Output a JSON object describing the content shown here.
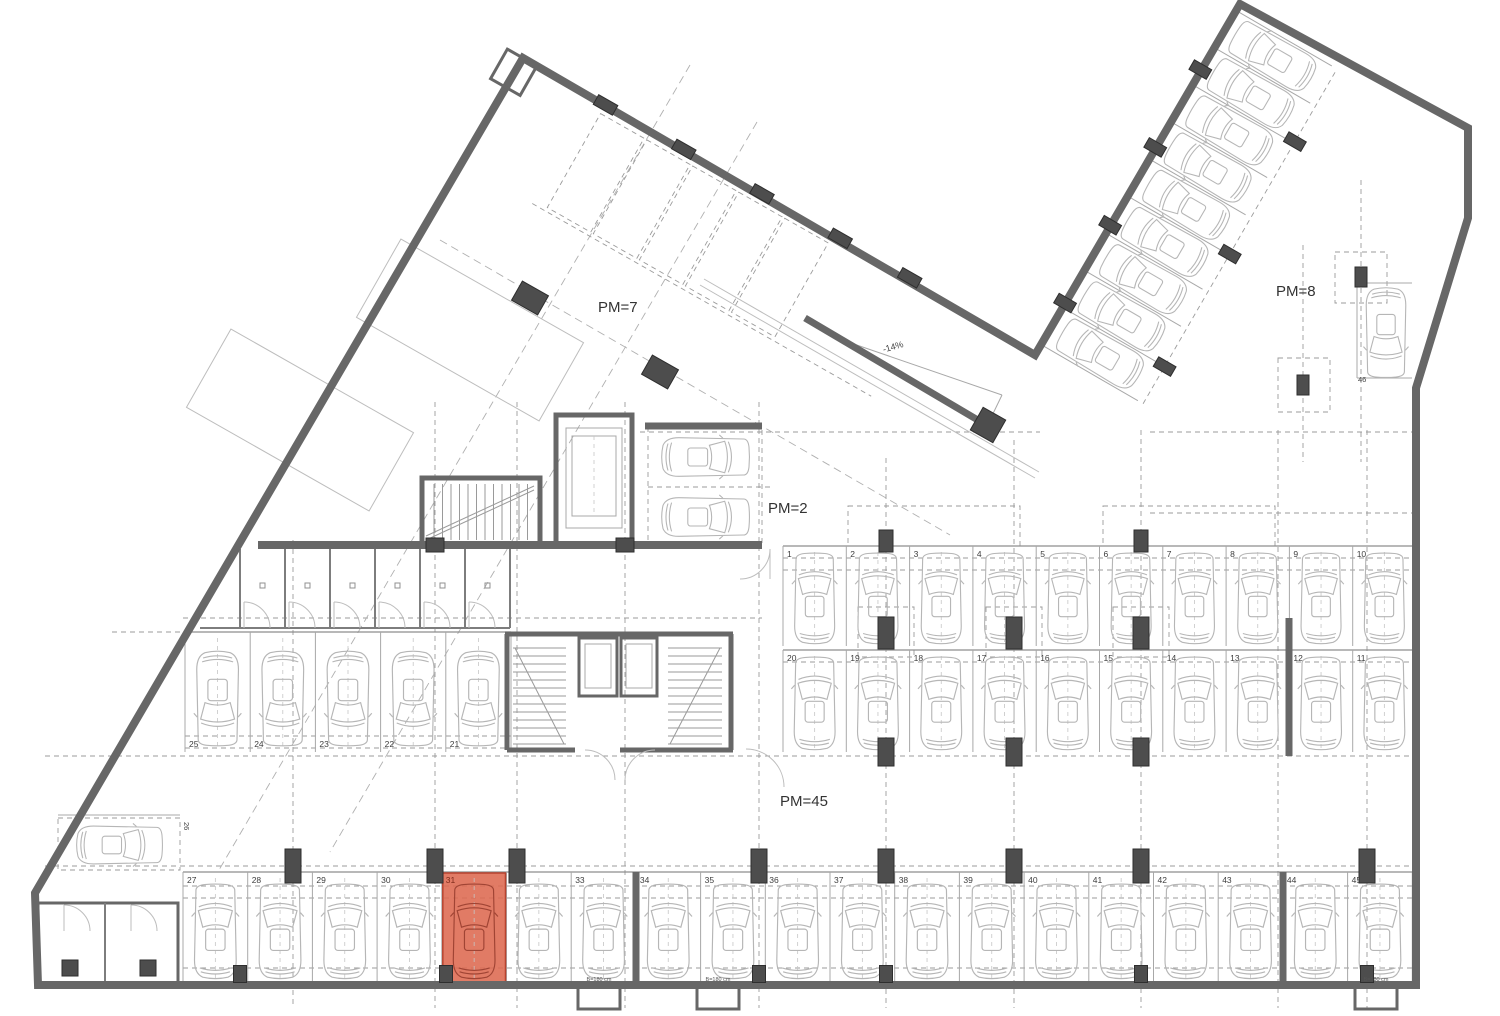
{
  "plan": {
    "labels": {
      "zone_pm7": "PM=7",
      "zone_pm8": "PM=8",
      "zone_pm2": "PM=2",
      "zone_pm45": "PM=45",
      "ramp_slope": "-14%",
      "stall_46": "46",
      "stall_26": "26",
      "niche_width": "B=180 cm"
    },
    "colors": {
      "wall": "#676767",
      "column": "#4d4d4d",
      "car": "#b6b6b6",
      "highlight_fill": "#dd6950",
      "highlight_stroke": "#b8432e",
      "highlight_car": "#a04434"
    },
    "rows": {
      "upper": {
        "numbers": [
          "1",
          "2",
          "3",
          "4",
          "5",
          "6",
          "7",
          "8",
          "9",
          "10"
        ]
      },
      "middle": {
        "numbers": [
          "20",
          "19",
          "18",
          "17",
          "16",
          "15",
          "14",
          "13",
          "12",
          "11"
        ]
      },
      "left": {
        "numbers": [
          "25",
          "24",
          "23",
          "22",
          "21"
        ]
      },
      "bottom": {
        "numbers": [
          "27",
          "28",
          "29",
          "30",
          "31",
          "32",
          "33",
          "34",
          "35",
          "36",
          "37",
          "38",
          "39",
          "40",
          "41",
          "42",
          "43",
          "44",
          "45"
        ],
        "highlighted": "31"
      },
      "diagonal_parking_count": 9
    }
  }
}
